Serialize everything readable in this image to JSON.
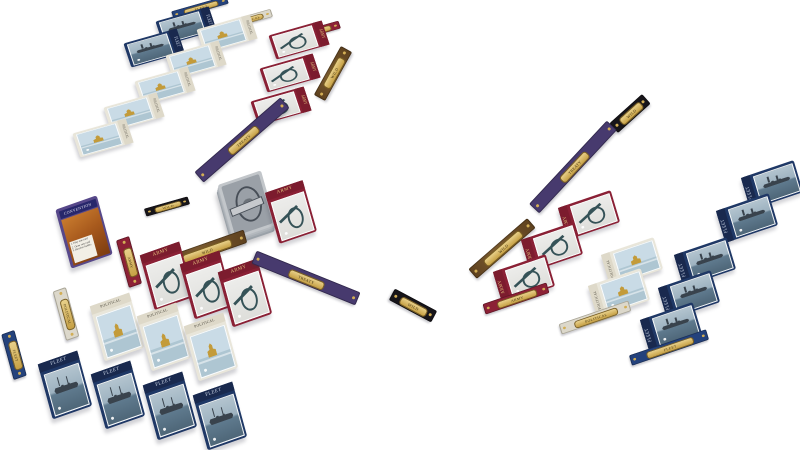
{
  "scene": {
    "background": "#ffffff",
    "type": "card game tableau"
  },
  "card_types": {
    "fleet": {
      "label": "FLEET",
      "frame": "#1f3866",
      "band": "#19294e",
      "band_text": "#cfd9ea"
    },
    "army": {
      "label": "ARMY",
      "frame": "#8a2035",
      "band": "#7c1c2e",
      "band_text": "#e7c77f"
    },
    "political": {
      "label": "POLITICAL",
      "frame": "#e9e6da",
      "band": "#ded9c9",
      "band_text": "#4f4b40"
    }
  },
  "strips": {
    "fleet": "FLEET",
    "army": "ARMY",
    "political": "POLITICAL",
    "wild": "WILD",
    "treaty": "TREATY"
  },
  "reference_card": {
    "title": "CONVENTION",
    "lines": [
      "1. Play one card",
      "2. Draw one card",
      "3. Resolve battles"
    ]
  },
  "players": {
    "left": {
      "fleet_count": 2,
      "political_count": 5,
      "army_count": 3
    },
    "bottom": {
      "army_count": 3,
      "political_count": 3,
      "fleet_count": 4,
      "has_reference_card": true
    },
    "right": {
      "army_count": 3,
      "political_count": 2,
      "fleet_count": 5
    }
  },
  "center": {
    "draw_deck": true,
    "played_card_type": "ARMY"
  },
  "colors": {
    "gold_capsule": "#d2ae55",
    "wild_strip": "#5f421f",
    "treaty_strip": "#473a6e",
    "black_strip": "#17151a",
    "deck_back": "#9aa0a7"
  }
}
